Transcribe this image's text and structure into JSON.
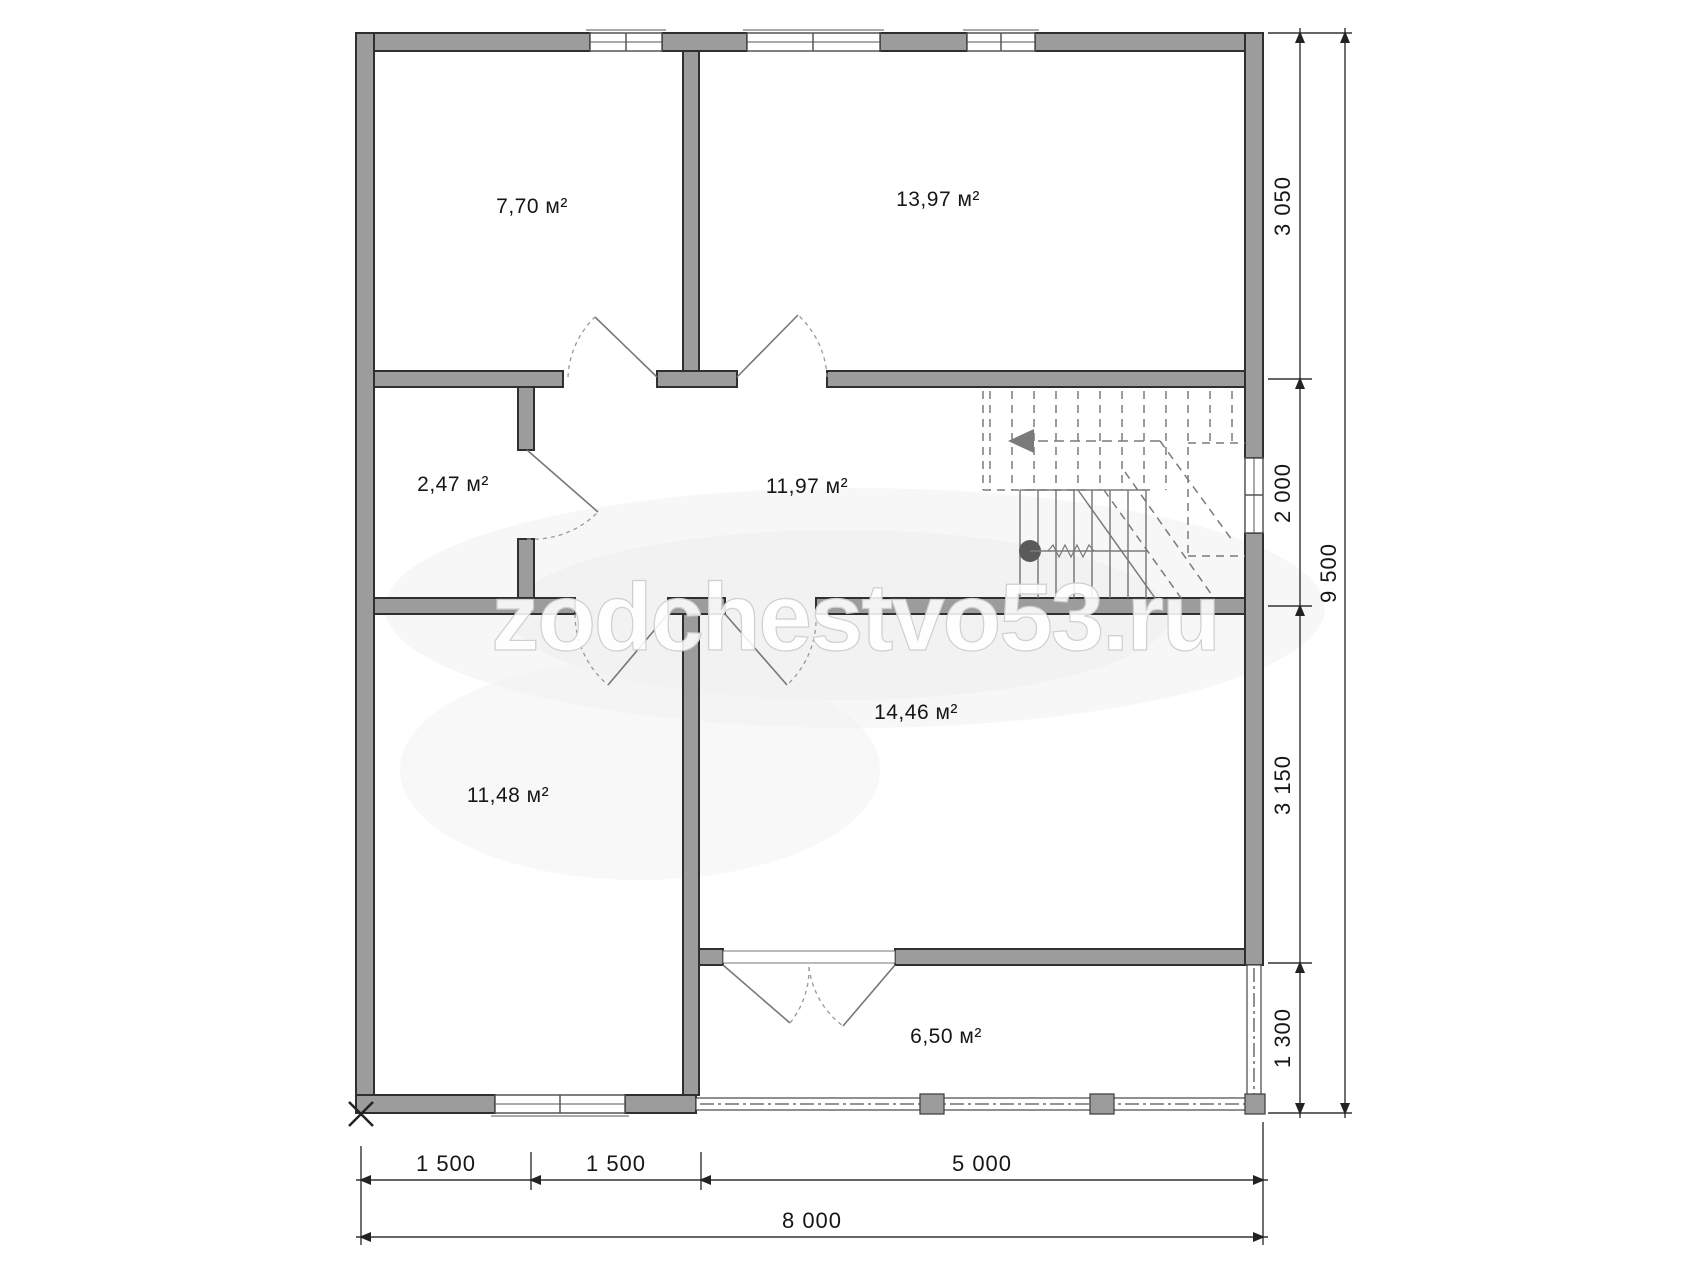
{
  "watermark": "zodchestvo53.ru",
  "rooms": [
    {
      "id": "room-top-left",
      "area_label": "7,70 м²"
    },
    {
      "id": "room-top-right",
      "area_label": "13,97 м²"
    },
    {
      "id": "room-closet",
      "area_label": "2,47 м²"
    },
    {
      "id": "room-hall",
      "area_label": "11,97 м²"
    },
    {
      "id": "room-bottom-left",
      "area_label": "11,48 м²"
    },
    {
      "id": "room-bottom-right",
      "area_label": "14,46 м²"
    },
    {
      "id": "room-balcony",
      "area_label": "6,50 м²"
    }
  ],
  "dimensions": {
    "right_segments": [
      "3 050",
      "2 000",
      "3 150",
      "1 300"
    ],
    "right_total": "9 500",
    "bottom_segments": [
      "1 500",
      "1 500",
      "5 000"
    ],
    "bottom_total": "8 000"
  },
  "colors": {
    "wall_fill": "#9c9c9c",
    "wall_outline": "#2f2f2f",
    "thin_line": "#555555",
    "stair_line": "#7a7a7a",
    "dim_line": "#333333",
    "watermark": "#cfcfcf"
  }
}
